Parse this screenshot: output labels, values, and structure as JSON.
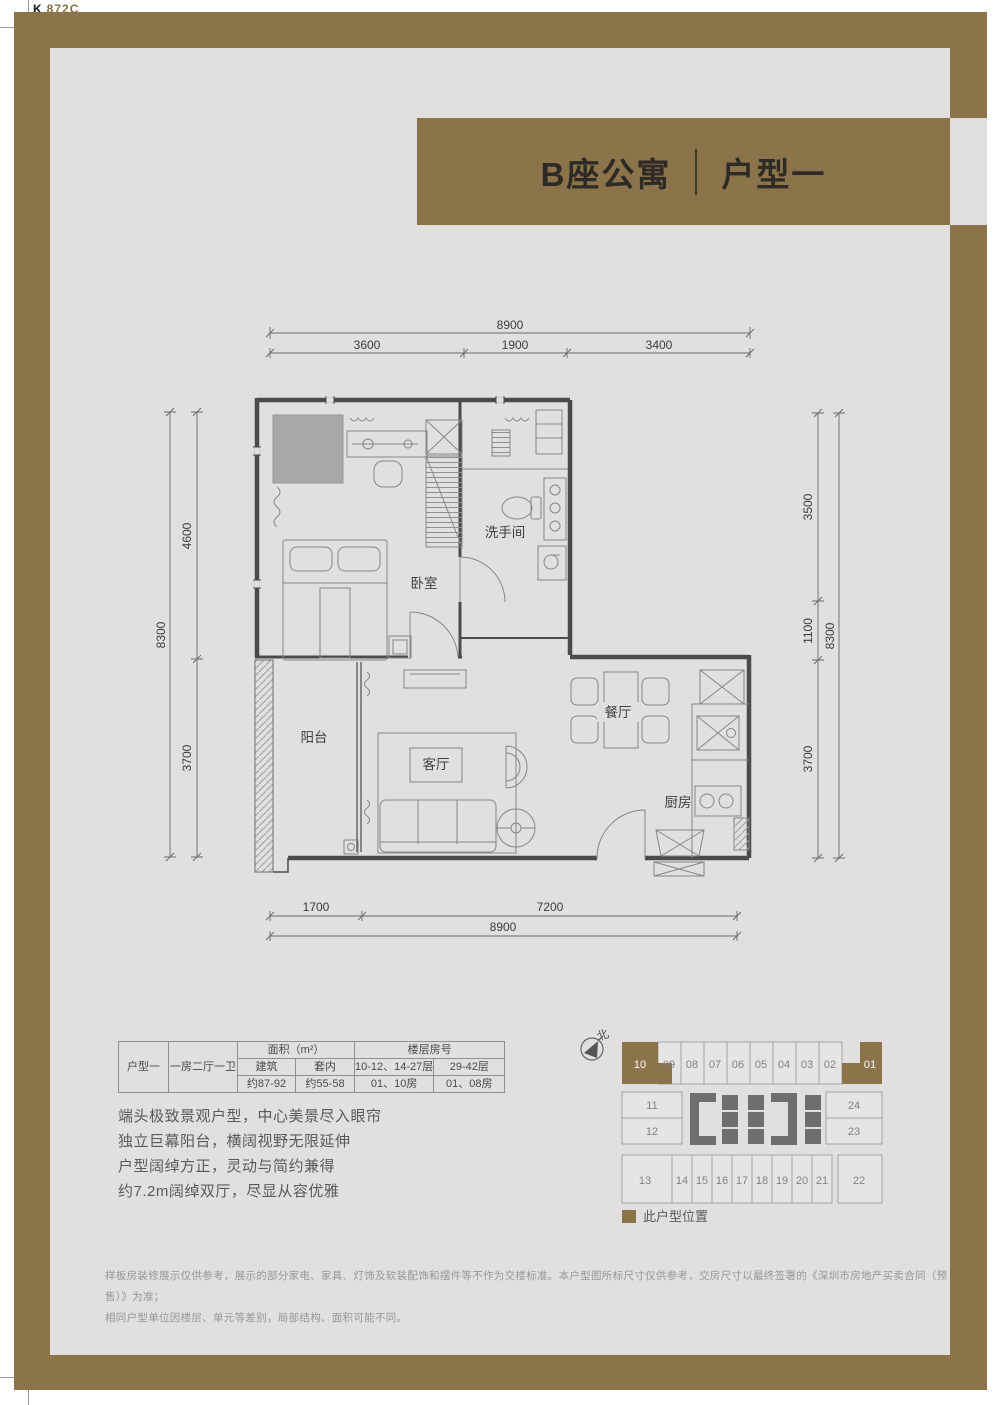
{
  "print_mark": {
    "k": "K",
    "code": "872C"
  },
  "header": {
    "building": "B座公寓",
    "unit": "户型一"
  },
  "floor_plan": {
    "rooms": {
      "bedroom": "卧室",
      "bathroom": "洗手间",
      "balcony": "阳台",
      "living": "客厅",
      "dining": "餐厅",
      "kitchen": "厨房"
    },
    "dimensions": {
      "top": {
        "total": "8900",
        "segments": [
          "3600",
          "1900",
          "3400"
        ]
      },
      "bottom": {
        "total": "8900",
        "segments": [
          "1700",
          "7200"
        ]
      },
      "left": {
        "total": "8300",
        "segments": [
          "4600",
          "3700"
        ]
      },
      "right": {
        "total": "8300",
        "segments": [
          "3500",
          "1100",
          "3700"
        ]
      }
    }
  },
  "spec_table": {
    "unit_type": "户型一",
    "layout": "一房二厅一卫",
    "area_header": "面积（m²）",
    "floor_header": "楼层房号",
    "area_cols": [
      "建筑",
      "套内"
    ],
    "floor_cols": [
      "10-12、14-27层",
      "29-42层"
    ],
    "area_values": [
      "约87-92",
      "约55-58"
    ],
    "floor_values": [
      "01、10房",
      "01、08房"
    ]
  },
  "features": [
    "端头极致景观户型，中心美景尽入眼帘",
    "独立巨幕阳台，横阔视野无限延伸",
    "户型阔绰方正，灵动与简约兼得",
    "约7.2m阔绰双厅，尽显从容优雅"
  ],
  "key_plan": {
    "north_label": "北",
    "top_row": [
      "10",
      "09",
      "08",
      "07",
      "06",
      "05",
      "04",
      "03",
      "02",
      "01"
    ],
    "mid_left": [
      "11",
      "12"
    ],
    "mid_right": [
      "24",
      "23"
    ],
    "bottom_row": [
      "13",
      "14",
      "15",
      "16",
      "17",
      "18",
      "19",
      "20",
      "21",
      "22"
    ],
    "legend": "此户型位置"
  },
  "disclaimer": [
    "样板房装修展示仅供参考，展示的部分家电、家具、灯饰及软装配饰和摆件等不作为交楼标准。本户型图所标尺寸仅供参考，交房尺寸以最终签署的《深圳市房地产买卖合同（预售）》为准；",
    "相同户型单位因楼层、单元等差别，局部结构、面积可能不同。"
  ],
  "colors": {
    "brand_gold": "#8b734a",
    "panel_gray": "#e1e0de"
  }
}
